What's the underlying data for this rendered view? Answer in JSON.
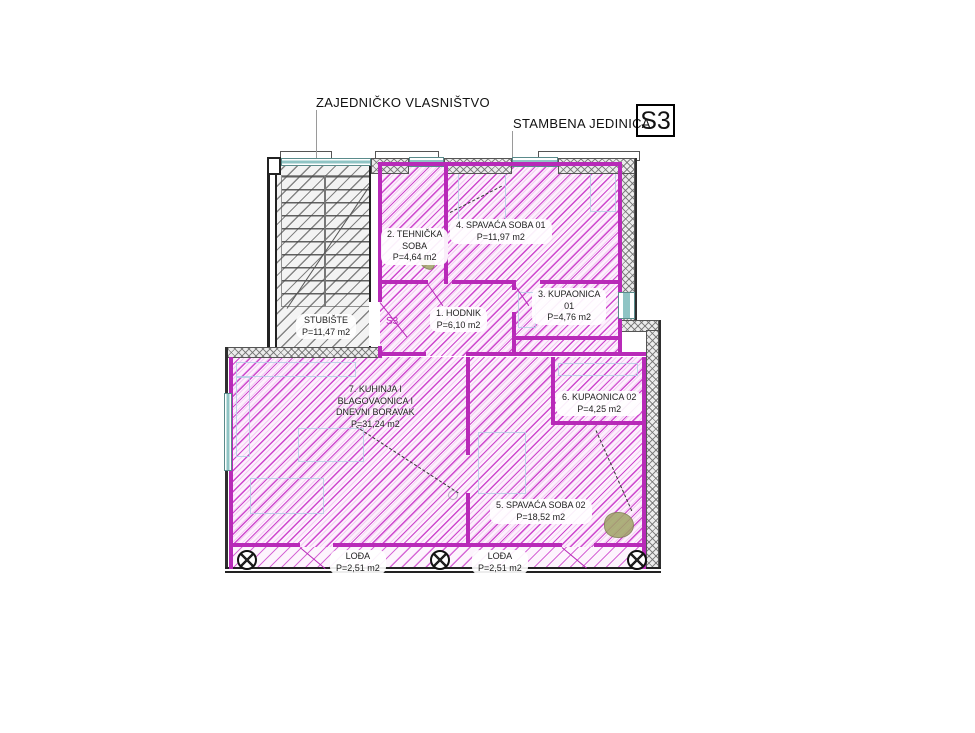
{
  "header": {
    "common_ownership": "ZAJEDNIČKO VLASNIŠTVO",
    "unit_type": "STAMBENA  JEDINICA",
    "unit_code": "S3"
  },
  "entry_code": "S3",
  "staircase": {
    "lines": [
      "STUBIŠTE",
      "P=11,47 m2"
    ]
  },
  "rooms": {
    "hodnik": {
      "lines": [
        "1. HODNIK",
        "P=6,10 m2"
      ]
    },
    "tehnicka": {
      "lines": [
        "2. TEHNIČKA",
        "SOBA",
        "P=4,64 m2"
      ]
    },
    "kupaonica01": {
      "lines": [
        "3. KUPAONICA",
        "01",
        "P=4,76 m2"
      ]
    },
    "spavaca01": {
      "lines": [
        "4. SPAVAĆA SOBA 01",
        "P=11,97 m2"
      ]
    },
    "spavaca02": {
      "lines": [
        "5. SPAVAĆA SOBA 02",
        "P=18,52 m2"
      ]
    },
    "kupaonica02": {
      "lines": [
        "6. KUPAONICA 02",
        "P=4,25 m2"
      ]
    },
    "kuhinja": {
      "lines": [
        "7. KUHINJA I",
        "BLAGOVAONICA I",
        "DNEVNI BORAVAK",
        "P=31,24 m2"
      ]
    },
    "lodja1": {
      "lines": [
        "LOĐA",
        "P=2,51 m2"
      ]
    },
    "lodja2": {
      "lines": [
        "LOĐA",
        "P=2,51 m2"
      ]
    }
  },
  "colors": {
    "unit_hatch": "#c939c9",
    "unit_wall": "#b82ab8",
    "common_hatch": "#6e6e6e",
    "outer_wall": "#222222",
    "window": "#8fc4c4",
    "label_text": "#222222"
  }
}
